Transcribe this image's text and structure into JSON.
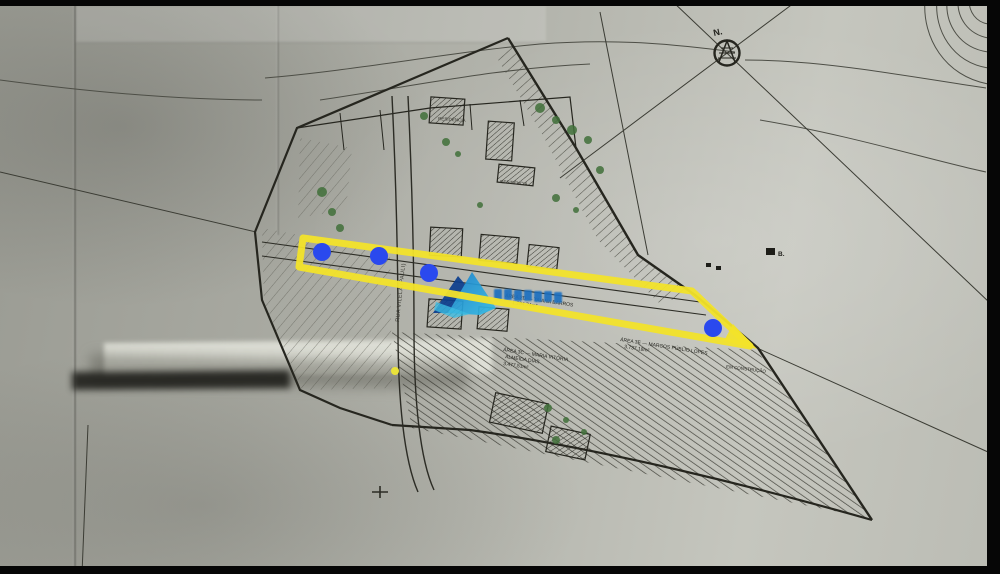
{
  "scene": {
    "compass_label": "N.",
    "marker_b_label": "B.",
    "road_label": "RUA VILELA (PAULI)",
    "construction_label": "EM CONSTRUÇÃO",
    "lot_label_1": "RESIDÊNCIA",
    "lot_label_2": "RESIDÊNCIA",
    "area_labels": {
      "a2d_line1": "ÁREA 2D — TAIANA BARROS",
      "a2d_line2": "1.294,74m²",
      "a3c_line1": "ÁREA 3C — MARIA VITÓRIA",
      "a3c_line2": "ALMEIDA DIAS",
      "a3c_line3": "3.477,51m²",
      "a3e_line1": "ÁREA 3E — MARCOS PÚBLIO LOPES",
      "a3e_line2": "3.737,18m²"
    }
  },
  "annotations": {
    "highlight_color": "#f2e32a",
    "marker_color": "#2a49ee",
    "highlight_polygon_points": "303,238 692,291 750,346 299,267",
    "arrow_tip_points": "733,324 757,349 724,341",
    "markers": [
      {
        "x": 322,
        "y": 252,
        "r": 9
      },
      {
        "x": 379,
        "y": 256,
        "r": 9
      },
      {
        "x": 429,
        "y": 273,
        "r": 9
      },
      {
        "x": 713,
        "y": 328,
        "r": 9
      }
    ],
    "small_marker": {
      "x": 395,
      "y": 371,
      "r": 4,
      "color": "#e9e23a"
    }
  },
  "watermark": {
    "type": "mountain-logo-watermark",
    "wordmark_legible": false,
    "colors": {
      "dark": "#0c3e8e",
      "mid": "#1b80cc",
      "light": "#33bde6"
    }
  }
}
